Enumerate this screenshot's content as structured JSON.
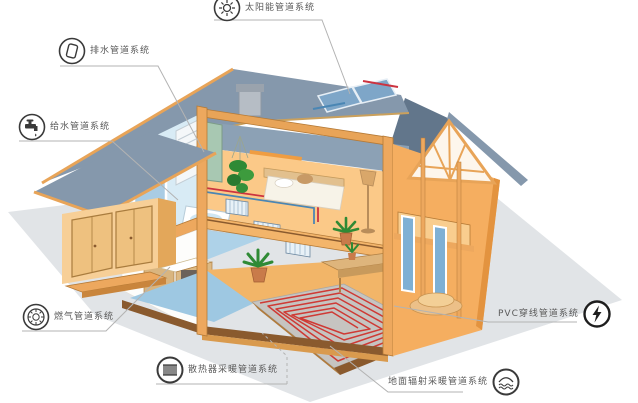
{
  "callouts": [
    {
      "id": "drainage",
      "text": "排水管道系统",
      "icon": "drain-pipe-icon"
    },
    {
      "id": "solar",
      "text": "太阳能管道系统",
      "icon": "sun-icon"
    },
    {
      "id": "water-supply",
      "text": "给水管道系统",
      "icon": "faucet-icon"
    },
    {
      "id": "gas",
      "text": "燃气管道系统",
      "icon": "gas-meter-icon"
    },
    {
      "id": "radiator-heating",
      "text": "散热器采暖管道系统",
      "icon": "radiator-icon"
    },
    {
      "id": "floor-radiant-heating",
      "text": "地面辐射采暖管道系统",
      "icon": "floor-heating-icon"
    },
    {
      "id": "pvc-conduit",
      "text": "PVC穿线管道系统",
      "icon": "lightning-icon"
    }
  ],
  "colors": {
    "roof_slate": "#8598ac",
    "roof_slate_dark": "#62768b",
    "wall_peach": "#f7cf97",
    "wall_orange": "#f0ab5e",
    "trim_orange": "#e8a458",
    "wood_brown": "#8a5a2e",
    "interior_blue": "#d8ebf5",
    "floor_blue": "#9ec8e2",
    "ground_gray": "#e1e4e7",
    "heating_slab_gray": "#c6c4c1",
    "pipe_red": "#cc3340",
    "pipe_blue": "#4a86b4",
    "leader_line": "#b3b3b3",
    "label_text": "#5a5a5a"
  }
}
